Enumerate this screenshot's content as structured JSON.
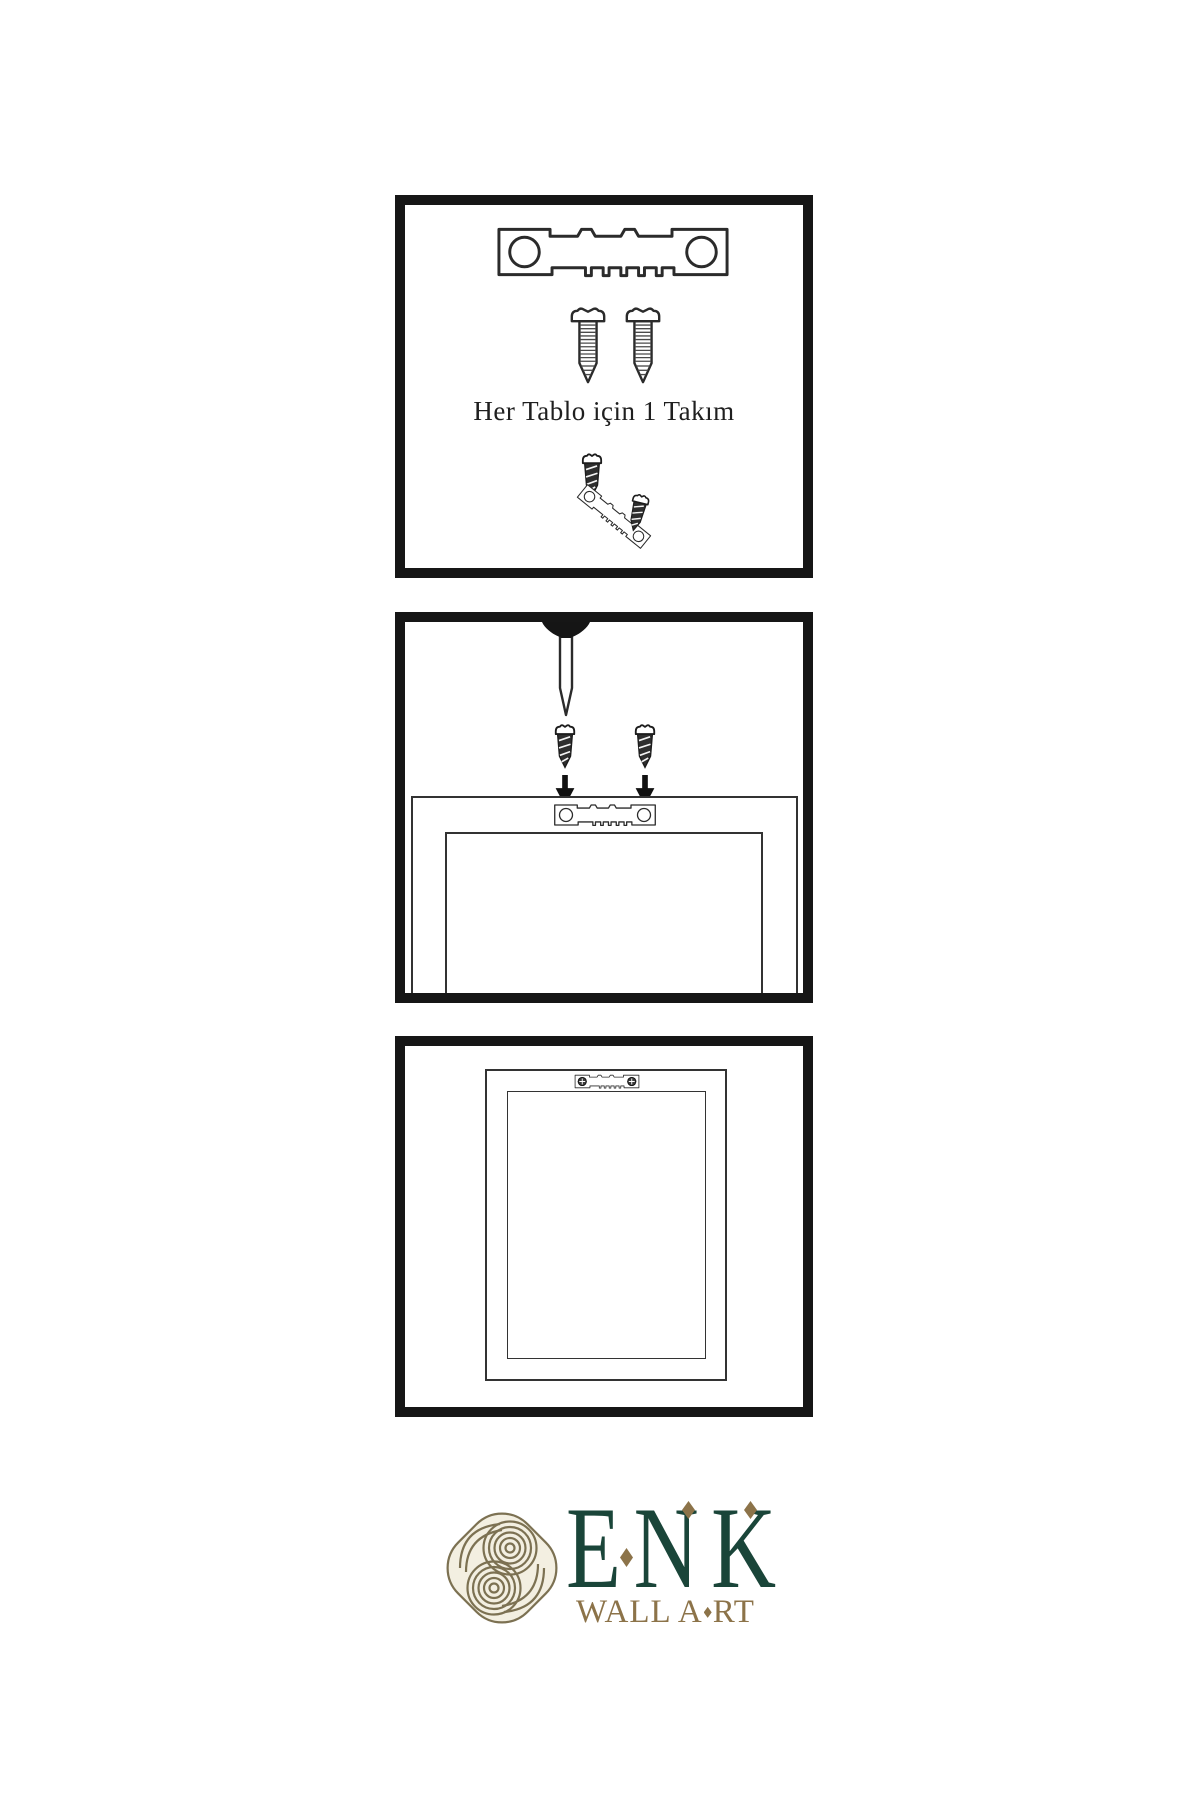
{
  "page": {
    "width": 1200,
    "height": 1800,
    "background": "#ffffff"
  },
  "colors": {
    "panel_border": "#161616",
    "line_art": "#2b2b2b",
    "caption_text": "#1f1f1f",
    "brand_green": "#1a4539",
    "brand_gold": "#8c7349",
    "emblem_gold": "#7c7152",
    "emblem_cream": "#f3efe1"
  },
  "panels": {
    "step1": {
      "name": "hardware-kit",
      "caption": "Her Tablo için 1 Takım",
      "icons": [
        "sawtooth-hanger-icon",
        "screw-icon",
        "screw-icon",
        "dark-screw-icon",
        "tilted-hanger-icon",
        "dark-screw-icon"
      ]
    },
    "step2": {
      "name": "mount-hanger-on-frame",
      "icons": [
        "wall-nail-icon",
        "dark-screw-icon",
        "dark-screw-icon",
        "down-arrow-icon",
        "down-arrow-icon",
        "frame-back-icon",
        "sawtooth-hanger-icon"
      ]
    },
    "step3": {
      "name": "hang-frame-on-wall",
      "icons": [
        "frame-back-icon",
        "mounted-hanger-icon",
        "phillips-screw-icon",
        "phillips-screw-icon"
      ]
    }
  },
  "logo": {
    "brand": "ENK",
    "tagline": "WALL ART",
    "tagline_before_diamond": "WALL A",
    "tagline_after_diamond": "RT",
    "emblem": "knot-emblem-icon"
  }
}
